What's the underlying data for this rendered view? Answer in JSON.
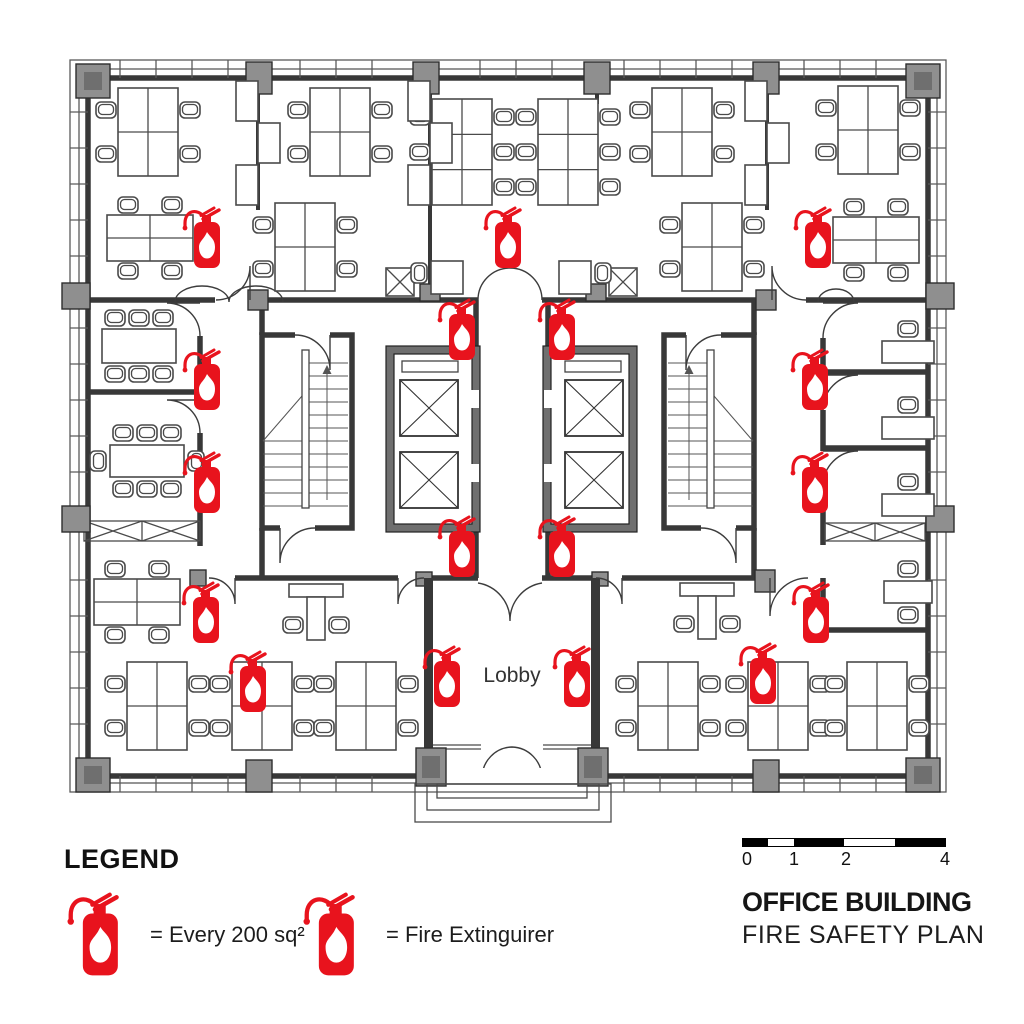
{
  "title_block": {
    "line1": "OFFICE BUILDING",
    "line2": "FIRE SAFETY PLAN"
  },
  "scale_bar": {
    "ticks": [
      "0",
      "1",
      "2",
      "4"
    ]
  },
  "legend": {
    "heading": "LEGEND",
    "items": [
      {
        "icon": "fire-extinguisher-icon",
        "text": "= Every 200 sq²"
      },
      {
        "icon": "fire-extinguisher-icon",
        "text": "= Fire Extinguirer"
      }
    ]
  },
  "colors": {
    "extinguisher_red": "#e8131d",
    "wall": "#383838",
    "column_gray": "#8f8f8f"
  },
  "plan": {
    "lobby_label": "Lobby",
    "extinguishers": [
      {
        "x": 207,
        "y": 238
      },
      {
        "x": 508,
        "y": 238
      },
      {
        "x": 818,
        "y": 238
      },
      {
        "x": 462,
        "y": 330
      },
      {
        "x": 562,
        "y": 330
      },
      {
        "x": 207,
        "y": 380
      },
      {
        "x": 815,
        "y": 380
      },
      {
        "x": 207,
        "y": 483
      },
      {
        "x": 815,
        "y": 483
      },
      {
        "x": 462,
        "y": 547
      },
      {
        "x": 562,
        "y": 547
      },
      {
        "x": 206,
        "y": 613
      },
      {
        "x": 816,
        "y": 613
      },
      {
        "x": 253,
        "y": 682
      },
      {
        "x": 447,
        "y": 677
      },
      {
        "x": 577,
        "y": 677
      },
      {
        "x": 763,
        "y": 674
      }
    ],
    "furniture": [
      {
        "type": "desk4v",
        "x": 148,
        "y": 132
      },
      {
        "type": "desk4h",
        "x": 150,
        "y": 238
      },
      {
        "type": "desk4v",
        "x": 340,
        "y": 132
      },
      {
        "type": "desk4v",
        "x": 305,
        "y": 247
      },
      {
        "type": "desk6",
        "x": 462,
        "y": 152
      },
      {
        "type": "desk6",
        "x": 568,
        "y": 152
      },
      {
        "type": "desk4v",
        "x": 682,
        "y": 132
      },
      {
        "type": "desk4v",
        "x": 712,
        "y": 247
      },
      {
        "type": "desk4v",
        "x": 868,
        "y": 130
      },
      {
        "type": "desk4h",
        "x": 876,
        "y": 240
      },
      {
        "type": "cab",
        "x": 258,
        "y": 145
      },
      {
        "type": "cab",
        "x": 430,
        "y": 145
      },
      {
        "type": "cab",
        "x": 767,
        "y": 145
      },
      {
        "type": "xcab",
        "x": 400,
        "y": 282
      },
      {
        "type": "xcab",
        "x": 623,
        "y": 282
      },
      {
        "type": "wdesk",
        "x": 447,
        "y": 277
      },
      {
        "type": "wdesk",
        "x": 575,
        "y": 277,
        "mirror": true
      },
      {
        "type": "conf6",
        "x": 139,
        "y": 346
      },
      {
        "type": "conf8",
        "x": 147,
        "y": 461
      },
      {
        "type": "sdesk",
        "x": 908,
        "y": 352
      },
      {
        "type": "sdesk",
        "x": 908,
        "y": 428
      },
      {
        "type": "sdesk",
        "x": 908,
        "y": 505
      },
      {
        "type": "sdesk2",
        "x": 908,
        "y": 592
      },
      {
        "type": "desk4h",
        "x": 137,
        "y": 602
      },
      {
        "type": "ldesk",
        "x": 316,
        "y": 618
      },
      {
        "type": "ldesk",
        "x": 707,
        "y": 617
      },
      {
        "type": "desk4v",
        "x": 157,
        "y": 706
      },
      {
        "type": "desk4v",
        "x": 262,
        "y": 706
      },
      {
        "type": "desk4v",
        "x": 366,
        "y": 706
      },
      {
        "type": "desk4v",
        "x": 668,
        "y": 706
      },
      {
        "type": "desk4v",
        "x": 778,
        "y": 706
      },
      {
        "type": "desk4v",
        "x": 877,
        "y": 706
      }
    ]
  }
}
